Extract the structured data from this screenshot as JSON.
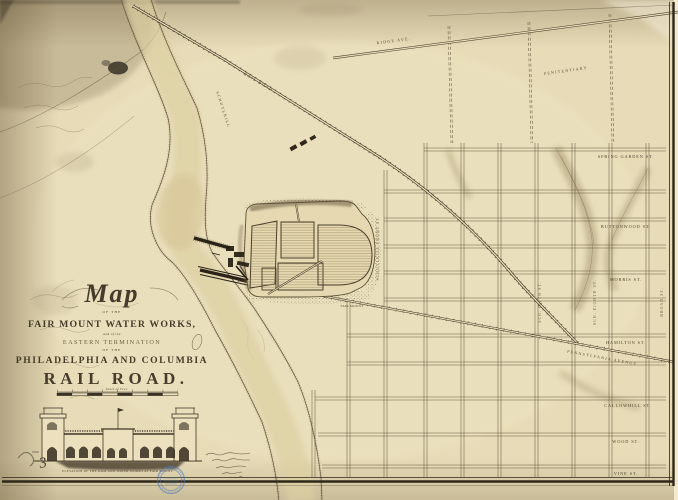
{
  "map": {
    "title": {
      "word_map": "Map",
      "of_the_upper": "OF THE",
      "line_waterworks": "FAIR MOUNT WATER WORKS,",
      "and_of_the": "and of the",
      "line_termination": "EASTERN TERMINATION",
      "of_the_lower": "OF THE",
      "line_company": "PHILADELPHIA AND COLUMBIA",
      "line_railroad": "RAIL ROAD.",
      "scale_caption": "Scale of Feet."
    },
    "streets": {
      "horizontal": [
        {
          "label": "SPRING GARDEN ST."
        },
        {
          "label": "BUTTONWOOD ST."
        },
        {
          "label": "MORRIS ST."
        },
        {
          "label": "HAMILTON ST."
        },
        {
          "label": "CALLOWHILL ST."
        },
        {
          "label": "WOOD ST."
        },
        {
          "label": "VINE ST."
        }
      ],
      "vertical": [
        {
          "label": "SCHUYLKILL FRONT ST."
        },
        {
          "label": "SCH. FIFTH ST."
        },
        {
          "label": "SCH. EIGHTH ST."
        },
        {
          "label": "BROAD ST."
        }
      ]
    },
    "roads": {
      "ridge_avenue": "RIDGE AVE.",
      "pennsylvania_avenue": "PENNSYLVANIA AVENUE",
      "rail_road": "RAIL ROAD"
    },
    "features": {
      "river": "SCHUYLKILL",
      "penitentiary": "PENITENTIARY",
      "fair_mount": "FAIR MOUNT"
    },
    "elevation": {
      "caption": "ELEVATION OF THE DAM AND WATER WORKS AT FAIR MOUNT."
    },
    "annotations": {
      "pencil_number": "3"
    },
    "colors": {
      "paper": "#e8dcb8",
      "ink": "#453b2a",
      "stamp_blue": "#4d7ab8"
    }
  }
}
